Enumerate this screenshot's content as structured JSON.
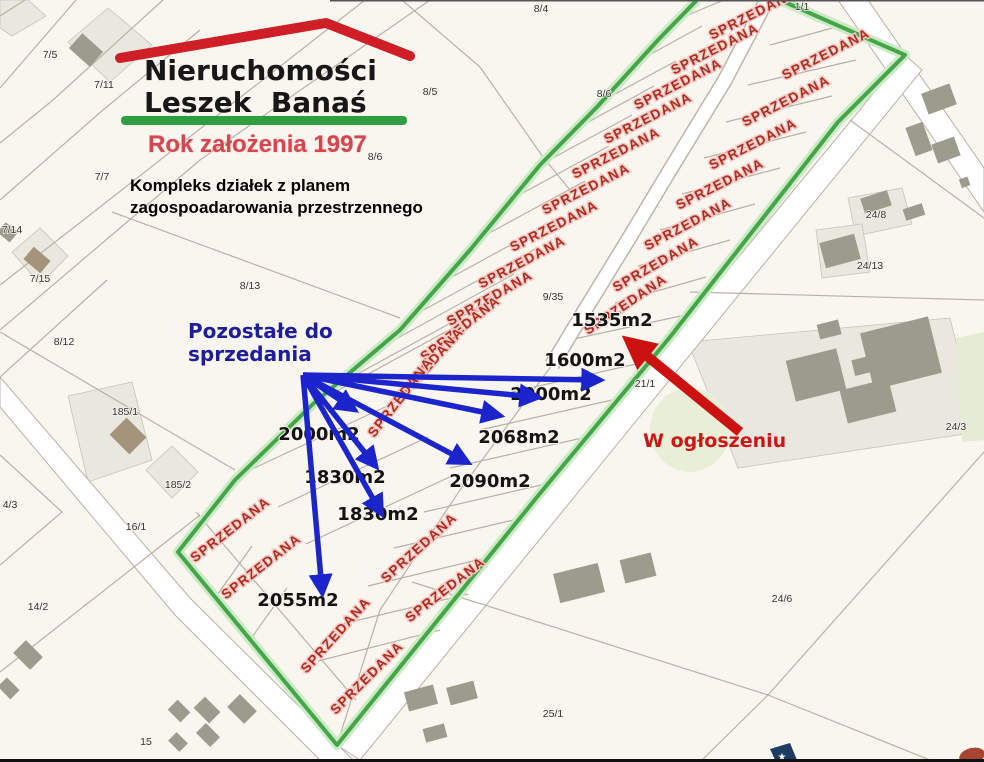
{
  "branding": {
    "line1": "Nieruchomości",
    "line2": "Leszek  Banaś",
    "tagline": "Rok założenia 1997",
    "subtitle1": "Kompleks działek z planem",
    "subtitle2": "zagospoadarowania przestrzennego",
    "roof_color": "#cf1f26",
    "bar_color": "#2f9e41"
  },
  "annotations": {
    "remaining": {
      "line1": "Pozostałe do",
      "line2": "sprzedania",
      "color": "#1e1e9c"
    },
    "in_ad": {
      "text": "W ogłoszeniu",
      "color": "#cf1616"
    },
    "sold_text": "SPRZEDANA",
    "sold_color": "#ab2d20",
    "arrow_blue": "#1c24cc",
    "arrow_red": "#cc1111",
    "boundary_green": "#44a649"
  },
  "sold_labels": [
    {
      "x": 755,
      "y": 18,
      "r": -27
    },
    {
      "x": 717,
      "y": 53,
      "r": -27
    },
    {
      "x": 680,
      "y": 88,
      "r": -27
    },
    {
      "x": 650,
      "y": 122,
      "r": -27
    },
    {
      "x": 618,
      "y": 157,
      "r": -27
    },
    {
      "x": 588,
      "y": 193,
      "r": -27
    },
    {
      "x": 556,
      "y": 230,
      "r": -27
    },
    {
      "x": 524,
      "y": 266,
      "r": -28
    },
    {
      "x": 492,
      "y": 302,
      "r": -30
    },
    {
      "x": 463,
      "y": 332,
      "r": -38
    },
    {
      "x": 432,
      "y": 368,
      "r": -48
    },
    {
      "x": 404,
      "y": 400,
      "r": -52
    },
    {
      "x": 828,
      "y": 58,
      "r": -27
    },
    {
      "x": 788,
      "y": 105,
      "r": -27
    },
    {
      "x": 755,
      "y": 148,
      "r": -27
    },
    {
      "x": 722,
      "y": 188,
      "r": -27
    },
    {
      "x": 690,
      "y": 228,
      "r": -28
    },
    {
      "x": 658,
      "y": 268,
      "r": -30
    },
    {
      "x": 628,
      "y": 308,
      "r": -34
    },
    {
      "x": 233,
      "y": 533,
      "r": -38
    },
    {
      "x": 264,
      "y": 570,
      "r": -38
    },
    {
      "x": 422,
      "y": 551,
      "r": -42
    },
    {
      "x": 448,
      "y": 593,
      "r": -38
    },
    {
      "x": 339,
      "y": 638,
      "r": -48
    },
    {
      "x": 370,
      "y": 681,
      "r": -45
    }
  ],
  "area_labels": [
    {
      "text": "1535m2",
      "x": 612,
      "y": 326
    },
    {
      "text": "1600m2",
      "x": 585,
      "y": 366
    },
    {
      "text": "2000m2",
      "x": 551,
      "y": 400
    },
    {
      "text": "2068m2",
      "x": 519,
      "y": 443
    },
    {
      "text": "2090m2",
      "x": 490,
      "y": 487
    },
    {
      "text": "2000m2",
      "x": 319,
      "y": 440
    },
    {
      "text": "1830m2",
      "x": 345,
      "y": 483
    },
    {
      "text": "1830m2",
      "x": 378,
      "y": 520
    },
    {
      "text": "2055m2",
      "x": 298,
      "y": 606
    }
  ],
  "parcel_numbers": [
    {
      "text": "8/4",
      "x": 541,
      "y": 12
    },
    {
      "text": "1/1",
      "x": 802,
      "y": 10
    },
    {
      "text": "7/5",
      "x": 50,
      "y": 58
    },
    {
      "text": "7/11",
      "x": 104,
      "y": 88
    },
    {
      "text": "8/5",
      "x": 430,
      "y": 95
    },
    {
      "text": "8/6",
      "x": 604,
      "y": 97
    },
    {
      "text": "8/6",
      "x": 375,
      "y": 160
    },
    {
      "text": "7/7",
      "x": 102,
      "y": 180
    },
    {
      "text": "24/8",
      "x": 876,
      "y": 218
    },
    {
      "text": "7/14",
      "x": 12,
      "y": 233
    },
    {
      "text": "24/13",
      "x": 870,
      "y": 269
    },
    {
      "text": "7/15",
      "x": 40,
      "y": 282
    },
    {
      "text": "8/13",
      "x": 250,
      "y": 289
    },
    {
      "text": "9/35",
      "x": 553,
      "y": 300
    },
    {
      "text": "8/12",
      "x": 64,
      "y": 345
    },
    {
      "text": "21/1",
      "x": 645,
      "y": 387
    },
    {
      "text": "185/1",
      "x": 125,
      "y": 415
    },
    {
      "text": "24/3",
      "x": 956,
      "y": 430
    },
    {
      "text": "185/2",
      "x": 178,
      "y": 488
    },
    {
      "text": "4/3",
      "x": 10,
      "y": 508
    },
    {
      "text": "16/1",
      "x": 136,
      "y": 530
    },
    {
      "text": "14/2",
      "x": 38,
      "y": 610
    },
    {
      "text": "24/6",
      "x": 782,
      "y": 602
    },
    {
      "text": "25/1",
      "x": 553,
      "y": 717
    },
    {
      "text": "15",
      "x": 146,
      "y": 745
    }
  ],
  "arrows": {
    "origin": {
      "x": 303,
      "y": 375
    },
    "blue_tips": [
      {
        "x": 597,
        "y": 380
      },
      {
        "x": 535,
        "y": 397
      },
      {
        "x": 497,
        "y": 415
      },
      {
        "x": 465,
        "y": 461
      },
      {
        "x": 352,
        "y": 408
      },
      {
        "x": 374,
        "y": 464
      },
      {
        "x": 380,
        "y": 511
      },
      {
        "x": 322,
        "y": 590
      }
    ],
    "red": {
      "x1": 740,
      "y1": 432,
      "x2": 631,
      "y2": 343
    }
  }
}
